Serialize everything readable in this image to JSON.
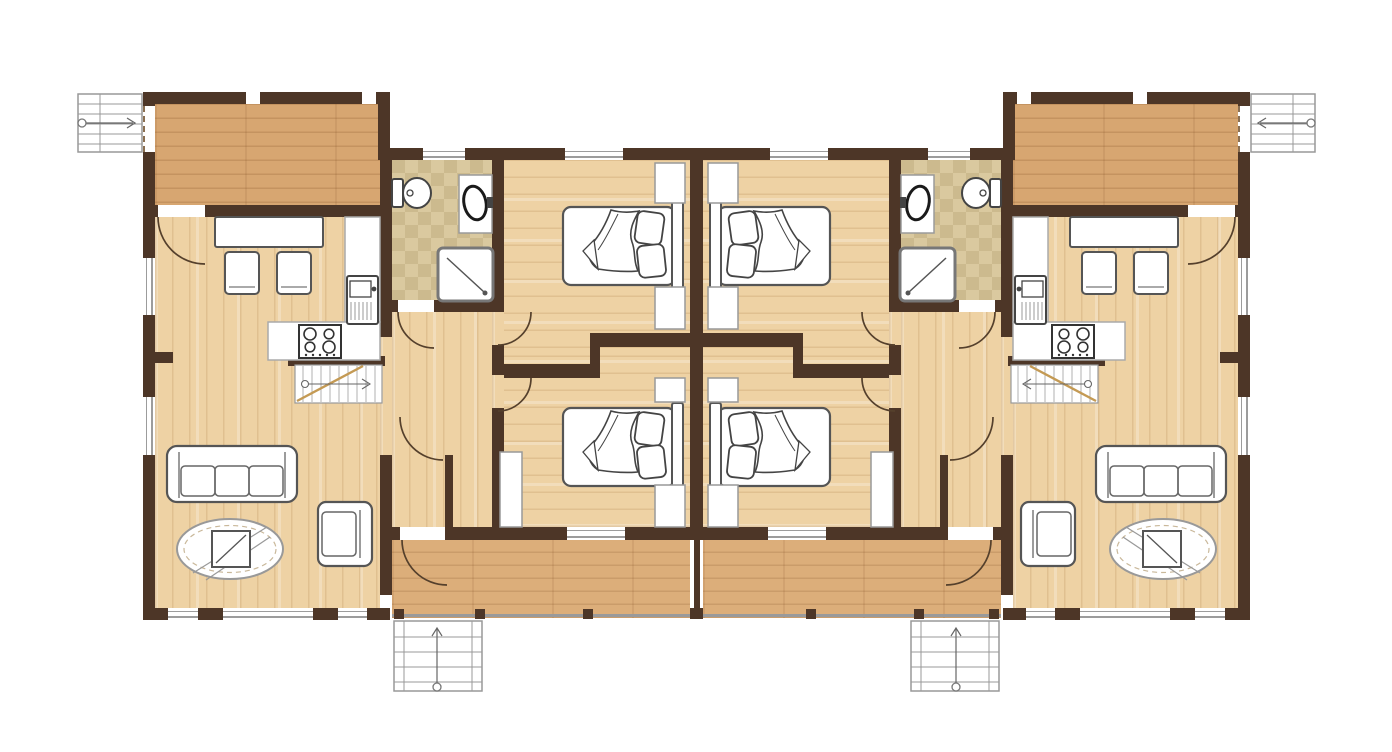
{
  "document": {
    "type": "architectural-floor-plan",
    "title": "Mirrored duplex apartment floor plan",
    "background": "#ffffff",
    "units_count": 2,
    "layout": "two identical mirror-image units sharing a central party wall"
  },
  "palette": {
    "wall": "#4d3627",
    "wood_floor": "#eed2a4",
    "terrace_floor_upper": "#d7a671",
    "terrace_floor_lower": "#dcae7a",
    "tile_floor": "#dac99f",
    "tile_floor_alt": "#ccba8e",
    "furniture_fill": "#ffffff",
    "furniture_stroke": "#555555",
    "door_arc": "#55402c",
    "stair_stroke": "#8f8f8f",
    "stair_break_line": "#c49a54",
    "railing": "#9a9a9a"
  },
  "units": [
    {
      "id": "unit-left",
      "rooms": [
        {
          "name": "upper terrace",
          "features": [
            "external staircase",
            "door to dining area",
            "wood deck"
          ]
        },
        {
          "name": "dining area",
          "furniture": [
            "dining table",
            "two chairs"
          ]
        },
        {
          "name": "kitchen",
          "furniture": [
            "sink unit",
            "four-burner stove",
            "L-shaped counter",
            "internal staircase"
          ]
        },
        {
          "name": "bathroom",
          "fixtures": [
            "toilet",
            "washbasin",
            "shower"
          ],
          "floor": "beige tile"
        },
        {
          "name": "hallway",
          "features": [
            "doors to bathroom, bedrooms and living room"
          ]
        },
        {
          "name": "bedroom 1",
          "furniture": [
            "double bed",
            "two pillows",
            "duvet",
            "wardrobes"
          ]
        },
        {
          "name": "bedroom 2",
          "furniture": [
            "double bed",
            "two pillows",
            "duvet",
            "wardrobes"
          ]
        },
        {
          "name": "living room",
          "furniture": [
            "three-seat sofa",
            "armchair",
            "coffee table",
            "oval rug"
          ]
        },
        {
          "name": "lower terrace",
          "features": [
            "entrance staircase",
            "railing",
            "doors from hallway and bedroom"
          ]
        }
      ]
    },
    {
      "id": "unit-right",
      "mirror_of": "unit-left",
      "rooms": [
        {
          "name": "upper terrace",
          "features": [
            "external staircase",
            "door to dining area",
            "wood deck"
          ]
        },
        {
          "name": "dining area",
          "furniture": [
            "dining table",
            "two chairs"
          ]
        },
        {
          "name": "kitchen",
          "furniture": [
            "sink unit",
            "four-burner stove",
            "L-shaped counter",
            "internal staircase"
          ]
        },
        {
          "name": "bathroom",
          "fixtures": [
            "toilet",
            "washbasin",
            "shower"
          ],
          "floor": "beige tile"
        },
        {
          "name": "hallway",
          "features": [
            "doors to bathroom, bedrooms and living room"
          ]
        },
        {
          "name": "bedroom 1",
          "furniture": [
            "double bed",
            "two pillows",
            "duvet",
            "wardrobes"
          ]
        },
        {
          "name": "bedroom 2",
          "furniture": [
            "double bed",
            "two pillows",
            "duvet",
            "wardrobes"
          ]
        },
        {
          "name": "living room",
          "furniture": [
            "three-seat sofa",
            "armchair",
            "coffee table",
            "oval rug"
          ]
        },
        {
          "name": "lower terrace",
          "features": [
            "entrance staircase",
            "railing",
            "doors from hallway and bedroom"
          ]
        }
      ]
    }
  ],
  "stairs": {
    "external": 4,
    "internal": 2
  }
}
